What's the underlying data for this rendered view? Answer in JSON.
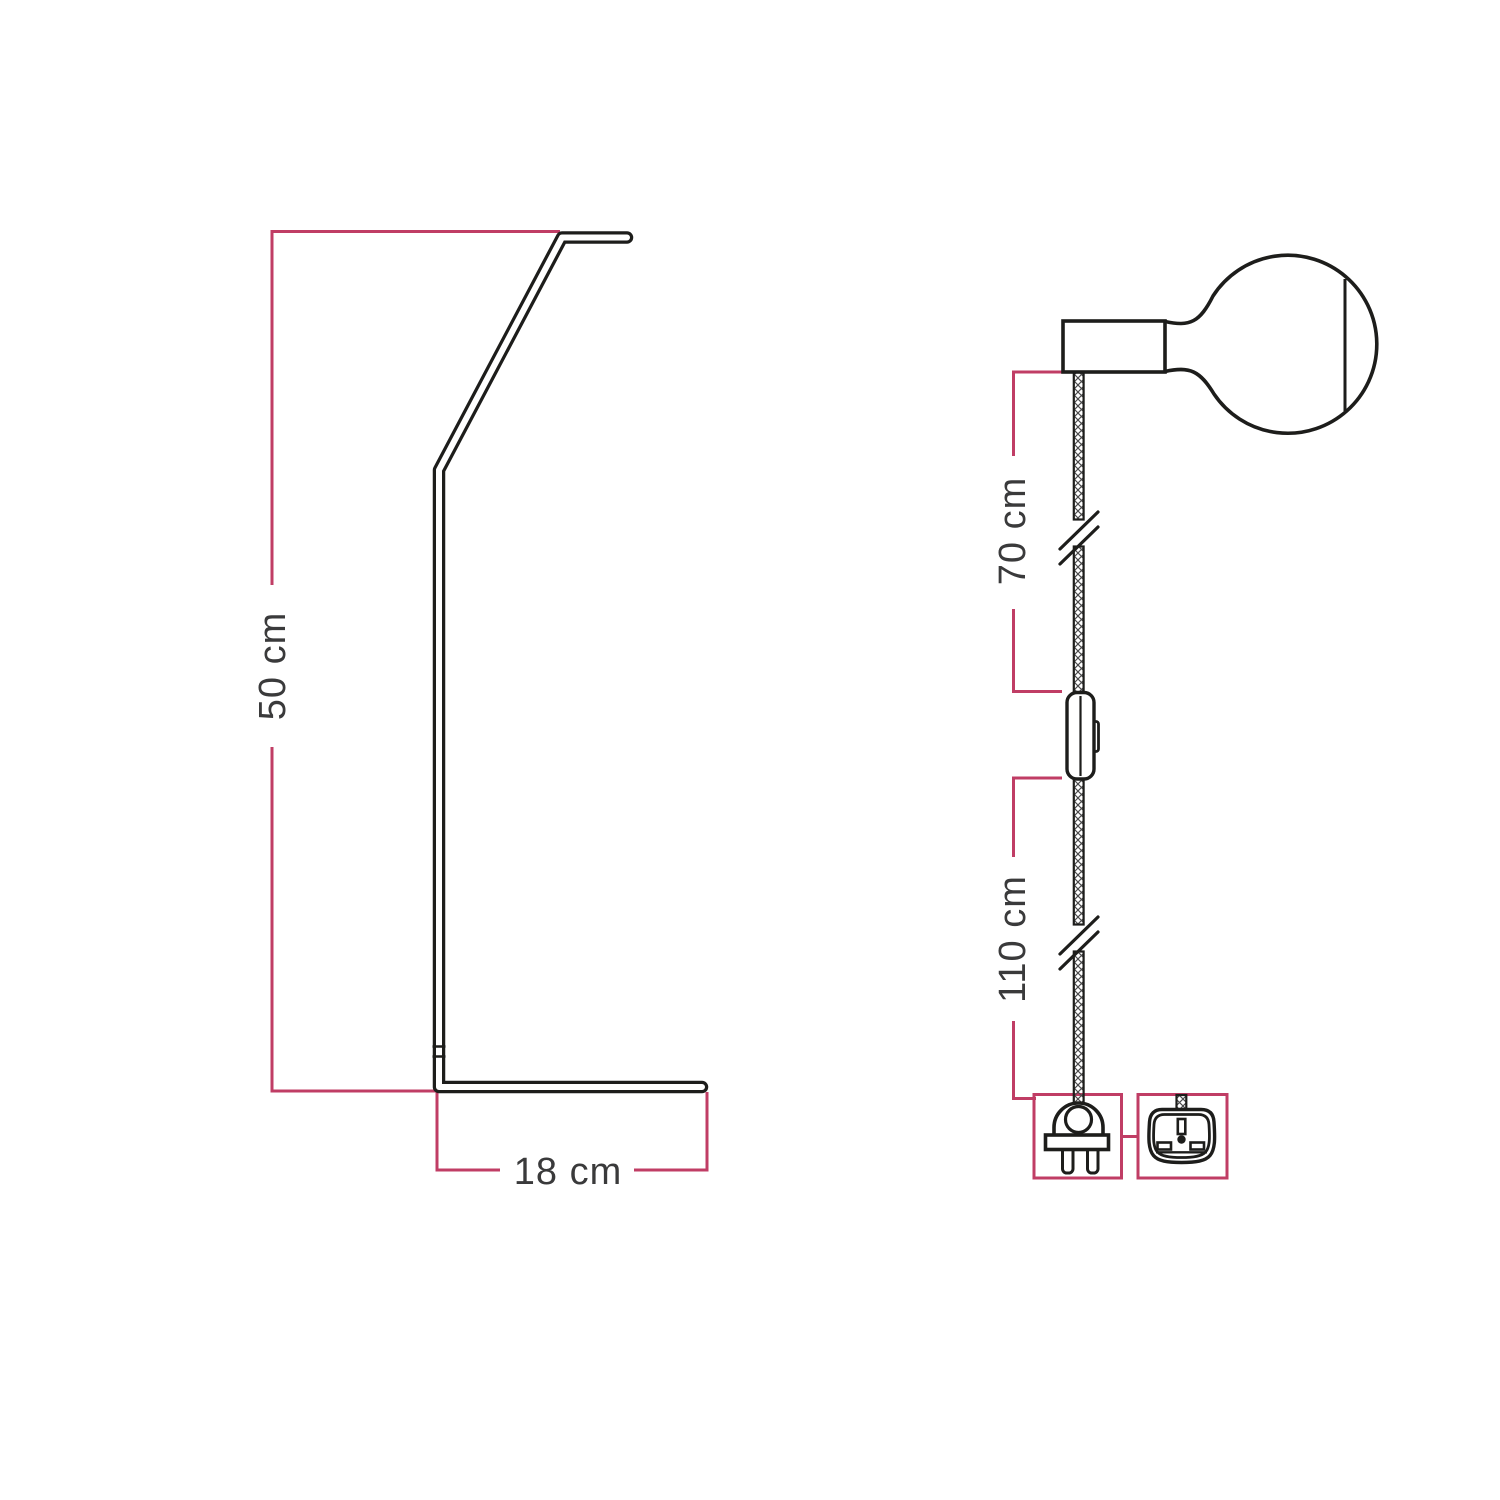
{
  "colors": {
    "accent-pink": "#C03D65",
    "line-black": "#1D1D1B",
    "text-gray": "#3A3A3B",
    "hatch-gray": "#4A4A4B",
    "background": "#FFFFFF"
  },
  "stand_diagram": {
    "description": "side profile of lamp stand",
    "height_dimension": "50 cm",
    "depth_dimension": "18 cm"
  },
  "pendant_diagram": {
    "description": "pendant cable with globe bulb, lamp holder, inline switch and plug",
    "upper_cable_dimension": "70 cm",
    "lower_cable_dimension": "110 cm",
    "icons": {
      "bulb": "globe-bulb-icon",
      "lamp_holder": "lamp-holder-icon",
      "cable": "textile-cable",
      "cable_break": "cable-break-mark",
      "switch": "inline-switch-icon",
      "plug_primary": "eu-two-pin-plug-icon",
      "plug_alternative": "uk-three-pin-plug-icon"
    }
  }
}
